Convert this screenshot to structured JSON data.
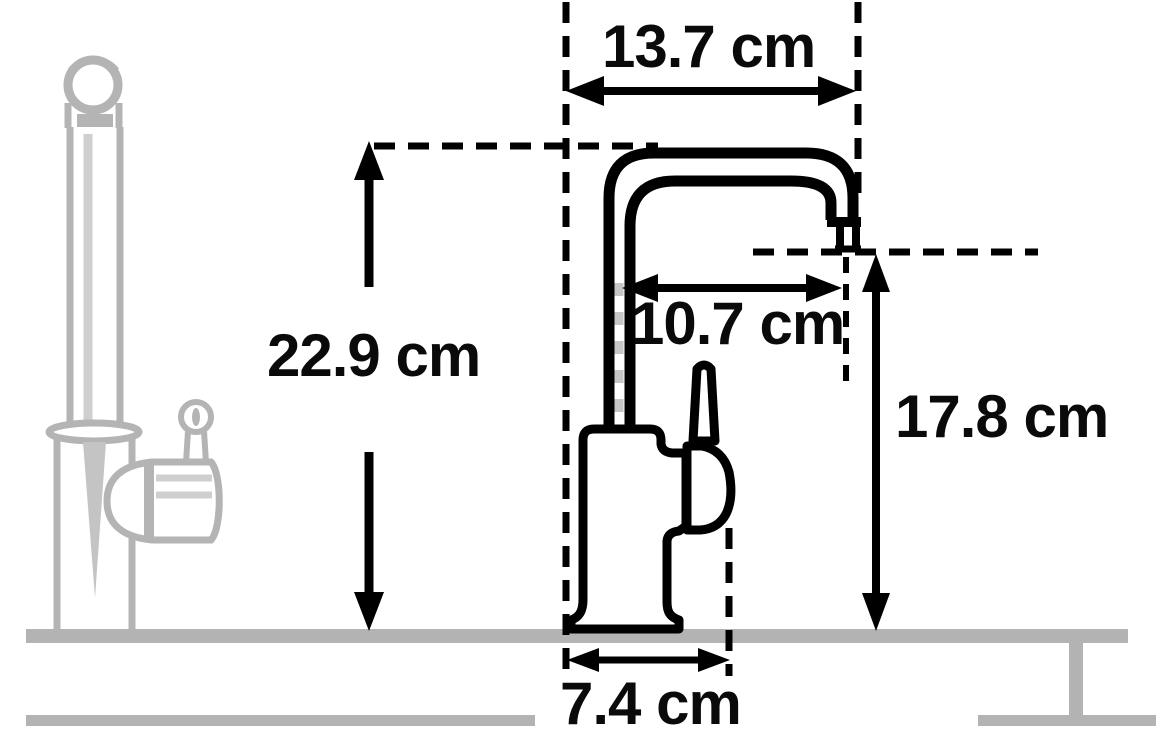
{
  "diagram": {
    "description": "Side-profile dimension drawing of a kitchen tap with U-shaped swan-neck spout, lever handle, ghost tap silhouette at left and countertop cross-section",
    "unit": "cm",
    "labels": {
      "spout_width": "13.7 cm",
      "spout_reach": "10.7 cm",
      "overall_height": "22.9 cm",
      "outlet_height": "17.8 cm",
      "base_width": "7.4 cm"
    },
    "measurements": {
      "spout_width_cm": 13.7,
      "spout_reach_cm": 10.7,
      "overall_height_cm": 22.9,
      "outlet_height_cm": 17.8,
      "base_width_cm": 7.4
    },
    "colors": {
      "ink": "#000000",
      "ghost_gray": "#b4b4b4",
      "ghost_light_gray": "#cfcfcf",
      "counter_gray": "#b3b3b3",
      "background": "#ffffff"
    }
  }
}
